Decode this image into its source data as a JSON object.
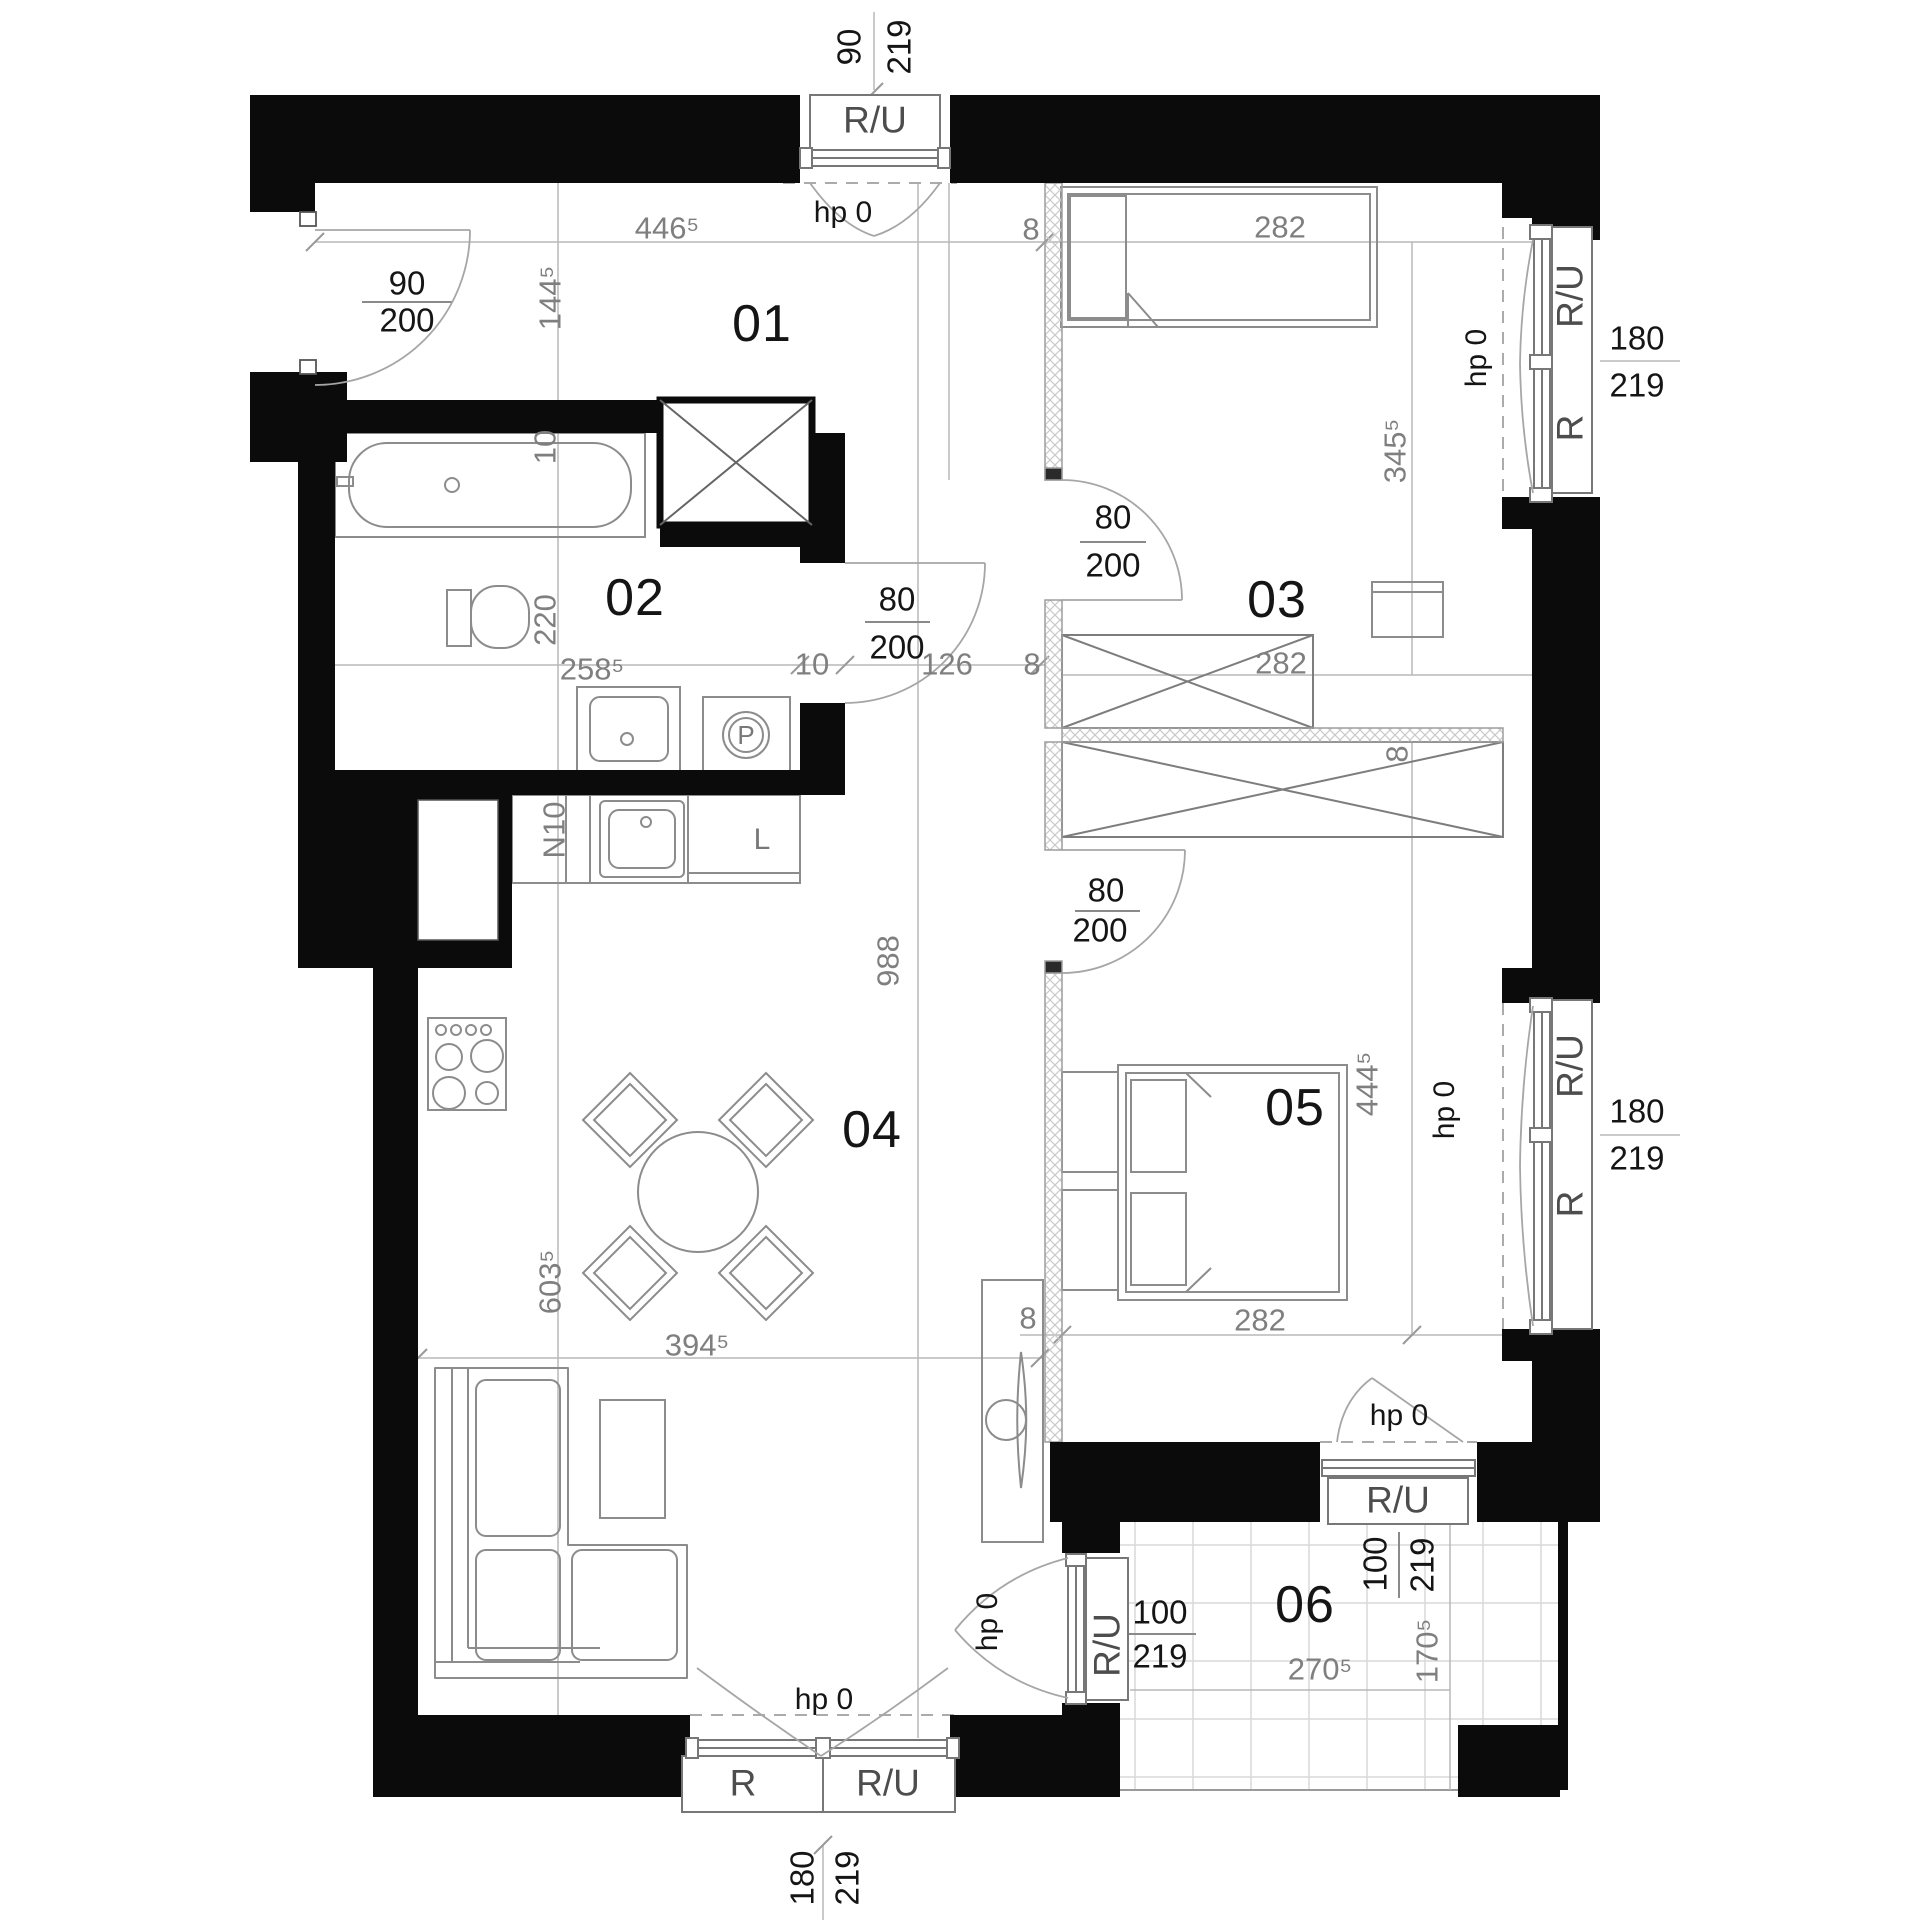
{
  "colors": {
    "wall": "#0b0b0b",
    "furniture_line": "#8c8c8c",
    "dim_text": "#7f7f7f",
    "strong_text": "#151515",
    "window_label": "#4d4d4d",
    "hatch": "#c9c9c9",
    "tile": "#d9d9d9",
    "dim_line": "#b8b8b8",
    "arc": "#a6a6a6"
  },
  "rooms": [
    {
      "name": "room-01-label",
      "text": "01",
      "x": 762,
      "y": 324,
      "rot": 0
    },
    {
      "name": "room-02-label",
      "text": "02",
      "x": 635,
      "y": 598,
      "rot": 0
    },
    {
      "name": "room-03-label",
      "text": "03",
      "x": 1277,
      "y": 600,
      "rot": 0
    },
    {
      "name": "room-04-label",
      "text": "04",
      "x": 872,
      "y": 1130,
      "rot": 0
    },
    {
      "name": "room-05-label",
      "text": "05",
      "x": 1295,
      "y": 1108,
      "rot": 0
    },
    {
      "name": "room-06-label",
      "text": "06",
      "x": 1305,
      "y": 1605,
      "rot": 0
    }
  ],
  "dimensions": [
    {
      "name": "dim-446-5",
      "text": "446⁵",
      "x": 667,
      "y": 228,
      "rot": 0
    },
    {
      "name": "dim-8-top",
      "text": "8",
      "x": 1031,
      "y": 229,
      "rot": 0
    },
    {
      "name": "dim-282-bed03",
      "text": "282",
      "x": 1280,
      "y": 227,
      "rot": 0
    },
    {
      "name": "dim-144-5",
      "text": "144⁵",
      "x": 550,
      "y": 298,
      "rot": -90
    },
    {
      "name": "dim-345-5",
      "text": "345⁵",
      "x": 1395,
      "y": 451,
      "rot": -90
    },
    {
      "name": "dim-10-tub",
      "text": "10",
      "x": 545,
      "y": 447,
      "rot": -90
    },
    {
      "name": "dim-220",
      "text": "220",
      "x": 545,
      "y": 620,
      "rot": -90
    },
    {
      "name": "dim-258-5",
      "text": "258⁵",
      "x": 592,
      "y": 669,
      "rot": 0
    },
    {
      "name": "dim-10-bath",
      "text": "10",
      "x": 812,
      "y": 664,
      "rot": 0
    },
    {
      "name": "dim-126",
      "text": "126",
      "x": 947,
      "y": 664,
      "rot": 0
    },
    {
      "name": "dim-8-mid",
      "text": "8",
      "x": 1032,
      "y": 664,
      "rot": 0
    },
    {
      "name": "dim-282-wardrobe",
      "text": "282",
      "x": 1281,
      "y": 663,
      "rot": 0
    },
    {
      "name": "dim-8-wardrobe",
      "text": "8",
      "x": 1397,
      "y": 754,
      "rot": -90
    },
    {
      "name": "dim-n10",
      "text": "N10",
      "x": 554,
      "y": 830,
      "rot": -90
    },
    {
      "name": "dim-988",
      "text": "988",
      "x": 888,
      "y": 961,
      "rot": -90
    },
    {
      "name": "dim-444-5",
      "text": "444⁵",
      "x": 1367,
      "y": 1084,
      "rot": -90
    },
    {
      "name": "dim-603-5",
      "text": "603⁵",
      "x": 550,
      "y": 1282,
      "rot": -90
    },
    {
      "name": "dim-394-5",
      "text": "394⁵",
      "x": 697,
      "y": 1345,
      "rot": 0
    },
    {
      "name": "dim-8-bed05",
      "text": "8",
      "x": 1028,
      "y": 1318,
      "rot": 0
    },
    {
      "name": "dim-282-bed05",
      "text": "282",
      "x": 1260,
      "y": 1320,
      "rot": 0
    },
    {
      "name": "dim-270-5",
      "text": "270⁵",
      "x": 1320,
      "y": 1669,
      "rot": 0
    },
    {
      "name": "dim-170-5",
      "text": "170⁵",
      "x": 1427,
      "y": 1651,
      "rot": -90
    }
  ],
  "door_window_sizes": [
    {
      "name": "size-entry-90",
      "text": "90",
      "x": 407,
      "y": 283,
      "rot": 0
    },
    {
      "name": "size-entry-200",
      "text": "200",
      "x": 407,
      "y": 320,
      "rot": 0
    },
    {
      "name": "size-topwin-90",
      "text": "90",
      "x": 849,
      "y": 47,
      "rot": -90
    },
    {
      "name": "size-topwin-219",
      "text": "219",
      "x": 899,
      "y": 47,
      "rot": -90
    },
    {
      "name": "size-rwin1-180",
      "text": "180",
      "x": 1637,
      "y": 338,
      "rot": 0
    },
    {
      "name": "size-rwin1-219",
      "text": "219",
      "x": 1637,
      "y": 385,
      "rot": 0
    },
    {
      "name": "size-bathdoor-80",
      "text": "80",
      "x": 897,
      "y": 599,
      "rot": 0
    },
    {
      "name": "size-bathdoor-200",
      "text": "200",
      "x": 897,
      "y": 647,
      "rot": 0
    },
    {
      "name": "size-door03-80",
      "text": "80",
      "x": 1113,
      "y": 517,
      "rot": 0
    },
    {
      "name": "size-door03-200",
      "text": "200",
      "x": 1113,
      "y": 565,
      "rot": 0
    },
    {
      "name": "size-door05-80",
      "text": "80",
      "x": 1106,
      "y": 890,
      "rot": 0
    },
    {
      "name": "size-door05-200",
      "text": "200",
      "x": 1100,
      "y": 930,
      "rot": 0
    },
    {
      "name": "size-rwin2-180",
      "text": "180",
      "x": 1637,
      "y": 1111,
      "rot": 0
    },
    {
      "name": "size-rwin2-219",
      "text": "219",
      "x": 1637,
      "y": 1158,
      "rot": 0
    },
    {
      "name": "size-door56-100",
      "text": "100",
      "x": 1375,
      "y": 1564,
      "rot": -90
    },
    {
      "name": "size-door56-219",
      "text": "219",
      "x": 1422,
      "y": 1565,
      "rot": -90
    },
    {
      "name": "size-door46-100",
      "text": "100",
      "x": 1160,
      "y": 1612,
      "rot": 0
    },
    {
      "name": "size-door46-219",
      "text": "219",
      "x": 1160,
      "y": 1656,
      "rot": 0
    },
    {
      "name": "size-botwin-180",
      "text": "180",
      "x": 802,
      "y": 1878,
      "rot": -90
    },
    {
      "name": "size-botwin-219",
      "text": "219",
      "x": 847,
      "y": 1878,
      "rot": -90
    }
  ],
  "window_labels": [
    {
      "name": "win-top-ru",
      "text": "R/U",
      "x": 875,
      "y": 120,
      "rot": 0
    },
    {
      "name": "win-right1-ru",
      "text": "R/U",
      "x": 1570,
      "y": 296,
      "rot": -90
    },
    {
      "name": "win-right1-r",
      "text": "R",
      "x": 1570,
      "y": 428,
      "rot": -90
    },
    {
      "name": "win-right2-ru",
      "text": "R/U",
      "x": 1570,
      "y": 1066,
      "rot": -90
    },
    {
      "name": "win-right2-r",
      "text": "R",
      "x": 1570,
      "y": 1204,
      "rot": -90
    },
    {
      "name": "win-door56-ru",
      "text": "R/U",
      "x": 1398,
      "y": 1500,
      "rot": 0
    },
    {
      "name": "win-door46-ru",
      "text": "R/U",
      "x": 1107,
      "y": 1645,
      "rot": -90
    },
    {
      "name": "win-bottom-r",
      "text": "R",
      "x": 743,
      "y": 1783,
      "rot": 0
    },
    {
      "name": "win-bottom-ru",
      "text": "R/U",
      "x": 888,
      "y": 1783,
      "rot": 0
    }
  ],
  "hp_labels": [
    {
      "name": "hp-top-window",
      "text": "hp 0",
      "x": 843,
      "y": 213,
      "rot": 0
    },
    {
      "name": "hp-window03",
      "text": "hp 0",
      "x": 1477,
      "y": 358,
      "rot": -90
    },
    {
      "name": "hp-window05",
      "text": "hp 0",
      "x": 1445,
      "y": 1110,
      "rot": -90
    },
    {
      "name": "hp-door56",
      "text": "hp 0",
      "x": 1399,
      "y": 1416,
      "rot": 0
    },
    {
      "name": "hp-door46",
      "text": "hp 0",
      "x": 988,
      "y": 1622,
      "rot": -90
    },
    {
      "name": "hp-bottom-window",
      "text": "hp 0",
      "x": 824,
      "y": 1700,
      "rot": 0
    }
  ],
  "appliance_labels": [
    {
      "name": "label-fridge-l",
      "text": "L",
      "x": 762,
      "y": 840,
      "rot": 0,
      "cls": "app"
    },
    {
      "name": "label-washer-p",
      "text": "P",
      "x": 746,
      "y": 735,
      "rot": 0,
      "cls": "app-p"
    }
  ]
}
